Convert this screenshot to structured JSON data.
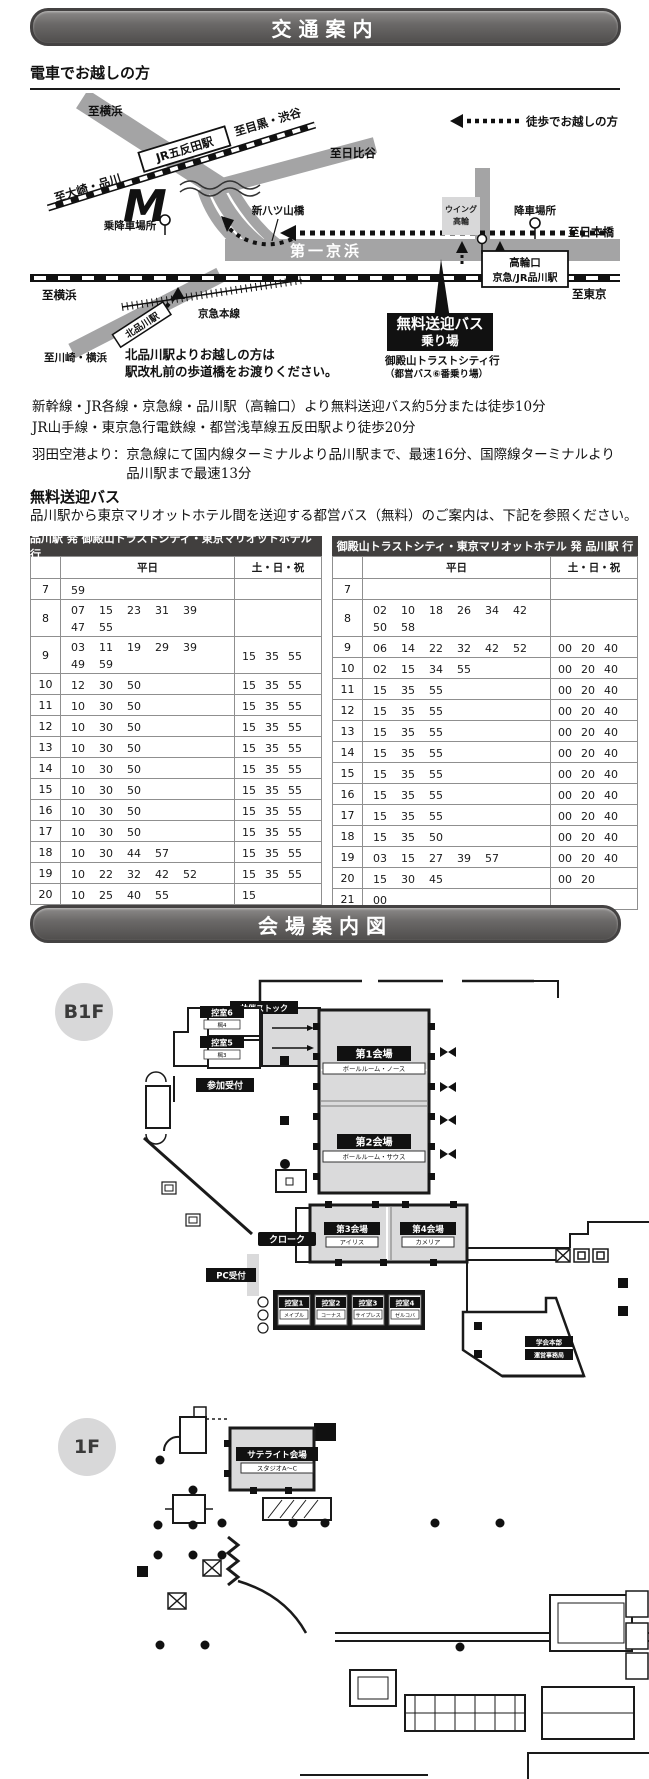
{
  "page": {
    "banner1": "交通案内",
    "banner2": "会場案内図"
  },
  "train": {
    "heading": "電車でお越しの方",
    "map": {
      "walk_legend": "徒歩でお越しの方",
      "to_yokohama_top": "至横浜",
      "to_meguro_shibuya": "至目黒・渋谷",
      "to_hibiya": "至日比谷",
      "to_osaki_shinagawa": "至大崎・品川",
      "jr_gotanda": "JR五反田駅",
      "shin_yatsuyama": "新八ツ山橋",
      "boarding_point": "乗降車場所",
      "daiichi_keihin": "第一京浜",
      "to_yokohama_left": "至横浜",
      "kita_shinagawa": "北品川駅",
      "keikyu_line": "京急本線",
      "to_kawasaki_yokohama": "至川崎・横浜",
      "kita_note_1": "北品川駅よりお越しの方は",
      "kita_note_2": "駅改札前の歩道橋をお渡りください。",
      "wing_takanawa_1": "ウイング",
      "wing_takanawa_2": "高輪",
      "alight_point": "降車場所",
      "to_nihonbashi": "至日本橋",
      "takanawa_exit": "高輪口",
      "shinagawa_sta": "京急/JR品川駅",
      "to_tokyo": "至東京",
      "free_bus_stop_1": "無料送迎バス",
      "free_bus_stop_2": "乗り場",
      "bus_dest_1": "御殿山トラストシティ行",
      "bus_dest_2": "（都営バス⑥番乗り場）",
      "marriott_logo": "M"
    },
    "notes": [
      "新幹線・JR各線・京急線・品川駅（高輪口）より無料送迎バス約5分または徒歩10分",
      "JR山手線・東京急行電鉄線・都営浅草線五反田駅より徒歩20分"
    ],
    "haneda_label": "羽田空港より：",
    "haneda_text": "京急線にて国内線ターミナルより品川駅まで、最速16分、国際線ターミナルより品川駅まで最速13分"
  },
  "bus": {
    "heading": "無料送迎バス",
    "description": "品川駅から東京マリオットホテル間を送迎する都営バス（無料）のご案内は、下記を参照ください。",
    "weekday_header": "平日",
    "holiday_header": "土・日・祝",
    "tables": [
      {
        "title": "品川駅 発  御殿山トラストシティ・東京マリオットホテル 行",
        "rows": [
          {
            "hour": "7",
            "weekday": [
              "59"
            ],
            "holiday": []
          },
          {
            "hour": "8",
            "weekday": [
              "07",
              "15",
              "23",
              "31",
              "39",
              "47",
              "55"
            ],
            "holiday": []
          },
          {
            "hour": "9",
            "weekday": [
              "03",
              "11",
              "19",
              "29",
              "39",
              "49",
              "59"
            ],
            "holiday": [
              "15",
              "35",
              "55"
            ]
          },
          {
            "hour": "10",
            "weekday": [
              "12",
              "30",
              "50"
            ],
            "holiday": [
              "15",
              "35",
              "55"
            ]
          },
          {
            "hour": "11",
            "weekday": [
              "10",
              "30",
              "50"
            ],
            "holiday": [
              "15",
              "35",
              "55"
            ]
          },
          {
            "hour": "12",
            "weekday": [
              "10",
              "30",
              "50"
            ],
            "holiday": [
              "15",
              "35",
              "55"
            ]
          },
          {
            "hour": "13",
            "weekday": [
              "10",
              "30",
              "50"
            ],
            "holiday": [
              "15",
              "35",
              "55"
            ]
          },
          {
            "hour": "14",
            "weekday": [
              "10",
              "30",
              "50"
            ],
            "holiday": [
              "15",
              "35",
              "55"
            ]
          },
          {
            "hour": "15",
            "weekday": [
              "10",
              "30",
              "50"
            ],
            "holiday": [
              "15",
              "35",
              "55"
            ]
          },
          {
            "hour": "16",
            "weekday": [
              "10",
              "30",
              "50"
            ],
            "holiday": [
              "15",
              "35",
              "55"
            ]
          },
          {
            "hour": "17",
            "weekday": [
              "10",
              "30",
              "50"
            ],
            "holiday": [
              "15",
              "35",
              "55"
            ]
          },
          {
            "hour": "18",
            "weekday": [
              "10",
              "30",
              "44",
              "57"
            ],
            "holiday": [
              "15",
              "35",
              "55"
            ]
          },
          {
            "hour": "19",
            "weekday": [
              "10",
              "22",
              "32",
              "42",
              "52"
            ],
            "holiday": [
              "15",
              "35",
              "55"
            ]
          },
          {
            "hour": "20",
            "weekday": [
              "10",
              "25",
              "40",
              "55"
            ],
            "holiday": [
              "15"
            ]
          }
        ]
      },
      {
        "title": "御殿山トラストシティ・東京マリオットホテル 発  品川駅 行",
        "rows": [
          {
            "hour": "7",
            "weekday": [],
            "holiday": []
          },
          {
            "hour": "8",
            "weekday": [
              "02",
              "10",
              "18",
              "26",
              "34",
              "42",
              "50",
              "58"
            ],
            "holiday": []
          },
          {
            "hour": "9",
            "weekday": [
              "06",
              "14",
              "22",
              "32",
              "42",
              "52"
            ],
            "holiday": [
              "00",
              "20",
              "40"
            ]
          },
          {
            "hour": "10",
            "weekday": [
              "02",
              "15",
              "34",
              "55"
            ],
            "holiday": [
              "00",
              "20",
              "40"
            ]
          },
          {
            "hour": "11",
            "weekday": [
              "15",
              "35",
              "55"
            ],
            "holiday": [
              "00",
              "20",
              "40"
            ]
          },
          {
            "hour": "12",
            "weekday": [
              "15",
              "35",
              "55"
            ],
            "holiday": [
              "00",
              "20",
              "40"
            ]
          },
          {
            "hour": "13",
            "weekday": [
              "15",
              "35",
              "55"
            ],
            "holiday": [
              "00",
              "20",
              "40"
            ]
          },
          {
            "hour": "14",
            "weekday": [
              "15",
              "35",
              "55"
            ],
            "holiday": [
              "00",
              "20",
              "40"
            ]
          },
          {
            "hour": "15",
            "weekday": [
              "15",
              "35",
              "55"
            ],
            "holiday": [
              "00",
              "20",
              "40"
            ]
          },
          {
            "hour": "16",
            "weekday": [
              "15",
              "35",
              "55"
            ],
            "holiday": [
              "00",
              "20",
              "40"
            ]
          },
          {
            "hour": "17",
            "weekday": [
              "15",
              "35",
              "55"
            ],
            "holiday": [
              "00",
              "20",
              "40"
            ]
          },
          {
            "hour": "18",
            "weekday": [
              "15",
              "35",
              "50"
            ],
            "holiday": [
              "00",
              "20",
              "40"
            ]
          },
          {
            "hour": "19",
            "weekday": [
              "03",
              "15",
              "27",
              "39",
              "57"
            ],
            "holiday": [
              "00",
              "20",
              "40"
            ]
          },
          {
            "hour": "20",
            "weekday": [
              "15",
              "30",
              "45"
            ],
            "holiday": [
              "00",
              "20"
            ]
          },
          {
            "hour": "21",
            "weekday": [
              "00"
            ],
            "holiday": []
          }
        ]
      }
    ]
  },
  "venue": {
    "b1f": {
      "floor_label": "B1F",
      "rooms": {
        "kyosai_stock": "共催ストック",
        "hikae6": "控室6",
        "hikae6_sub": "楓4",
        "hikae5": "控室5",
        "hikae5_sub": "楓3",
        "sanka_uketsuke": "参加受付",
        "hall1": "第1会場",
        "hall1_sub": "ボールルーム・ノース",
        "hall2": "第2会場",
        "hall2_sub": "ボールルーム・サウス",
        "hall3": "第3会場",
        "hall3_sub": "アイリス",
        "hall4": "第4会場",
        "hall4_sub": "カメリア",
        "cloak": "クローク",
        "pc_uketsuke": "PC受付",
        "hikae1": "控室1",
        "hikae1_sub": "メイプル",
        "hikae2": "控室2",
        "hikae2_sub": "コーナス",
        "hikae3": "控室3",
        "hikae3_sub": "サイプレス",
        "hikae4": "控室4",
        "hikae4_sub": "ゼルコバ",
        "hq1": "学会本部",
        "hq2": "運営事務局"
      }
    },
    "f1": {
      "floor_label": "1F",
      "rooms": {
        "satellite": "サテライト会場",
        "satellite_sub": "スタジオA〜C"
      }
    }
  }
}
